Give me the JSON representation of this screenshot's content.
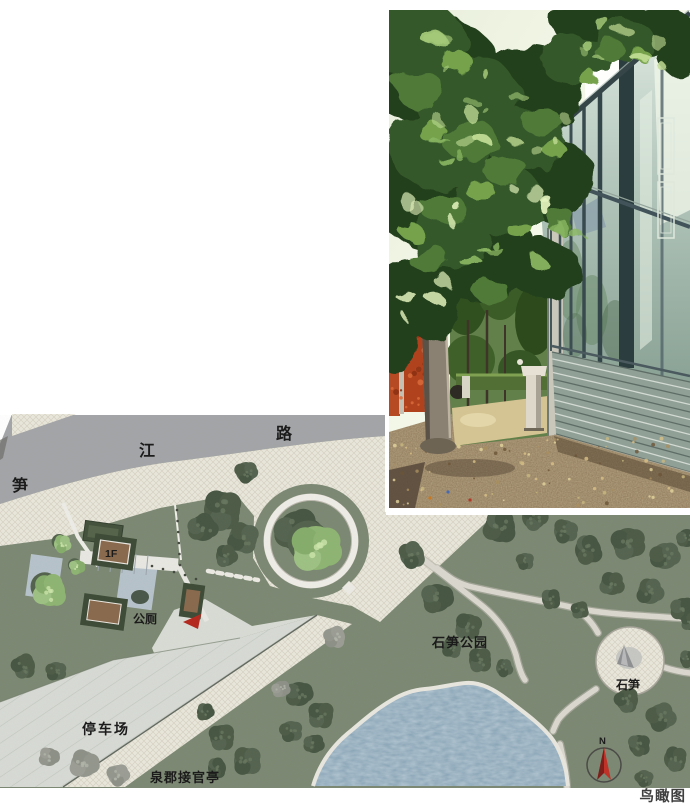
{
  "page": {
    "background": "#ffffff",
    "caption": "鸟瞰图"
  },
  "plan": {
    "road_name": "笋江路",
    "road_name_chars": [
      "笋",
      "江",
      "路"
    ],
    "labels": {
      "building_floor": "1F",
      "public_toilet": "公厕",
      "parking_lot": "停车场",
      "jieguan_pavilion": "泉郡接官亭",
      "shisun_park": "石笋公园",
      "shisun_stone": "石笋",
      "compass_north": "N"
    },
    "colors": {
      "road": "#a4a5a8",
      "plaza_paving": "#eae7dc",
      "lawn": "#7c8973",
      "tree_dark": "#4f5e49",
      "pond": "#87a3b6",
      "path": "#dbd8cf",
      "parking": "#d8dbd5",
      "roof_brown": "#8a6a4e",
      "marker_red": "#b5281e",
      "compass_red": "#c23127"
    }
  }
}
